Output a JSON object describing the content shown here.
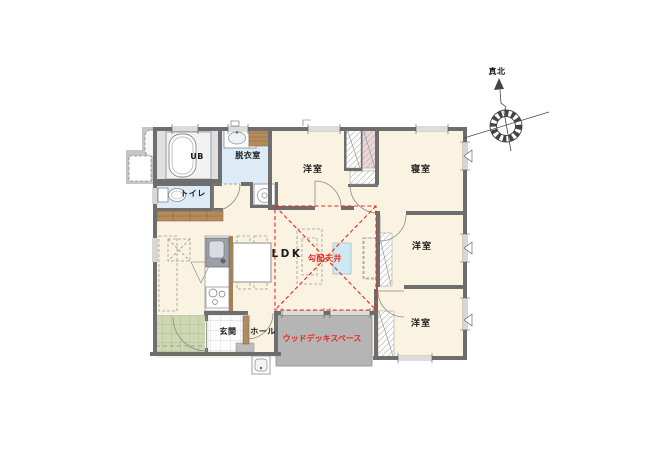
{
  "canvas": {
    "width": 645,
    "height": 468,
    "background": "#ffffff"
  },
  "colors": {
    "wall": "#6e6e6e",
    "floor": "#fbf3e2",
    "wet_floor": "#dcebf6",
    "ub_floor": "#e0e0e0",
    "porch_tile": "#cdd7b2",
    "deck": "#b5b5b5",
    "wood": "#b68b5c",
    "accent_red": "#e8281e",
    "skylight_blue": "#cfe9f2",
    "closet_pink": "#ecd7d8"
  },
  "labels": {
    "ub": "UB",
    "dressing_room": "脱衣室",
    "toilet": "トイレ",
    "western_room_top": "洋室",
    "bedroom": "寝室",
    "ldk": "LDK",
    "sloped_ceiling": "勾配天井",
    "western_room_middle": "洋室",
    "western_room_bottom": "洋室",
    "entrance": "玄関",
    "hall": "ホール",
    "wood_deck": "ウッドデッキスペース",
    "true_north": "真北"
  }
}
